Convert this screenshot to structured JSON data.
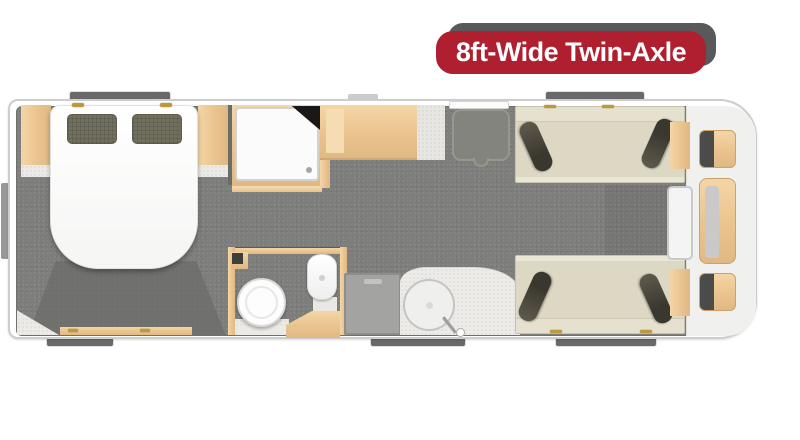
{
  "badge": {
    "label": "8ft-Wide Twin-Axle"
  },
  "colors": {
    "badge_red": "#b01f2f",
    "badge_shadow_gray": "#59595c",
    "badge_text": "#ffffff",
    "carpet_gray": "#7e7e7c",
    "wood_oak": "#e9c28d",
    "sofa_cream": "#ddd8c4",
    "cushion_dark": "#4a463c",
    "bathroom_floor": "#eceae6",
    "wall_white": "#ffffff",
    "window_gray": "#69696b"
  },
  "floorplan": {
    "vehicle": "twin-axle-caravan",
    "width_class": "8ft-wide",
    "layout_from_left": [
      "rear-island-bed-bedroom",
      "corner-shower",
      "washroom-with-toilet-and-basin",
      "wardrobe-kitchen-unit",
      "entrance-door",
      "kitchen-counter-with-sink-and-appliance",
      "lounge-with-twin-sofas",
      "front-chest-and-tables"
    ],
    "furniture": [
      "island-bed",
      "pillows",
      "bedside-cabinet-left",
      "bedside-cabinet-right",
      "shower-tray",
      "wardrobe-unit",
      "worktop",
      "toilet",
      "pedestal-basin",
      "wooden-step",
      "kitchen-appliance",
      "kitchen-counter",
      "round-sink-with-tap",
      "sofa-top",
      "sofa-bottom",
      "bolster-cushions",
      "side-tables",
      "center-table",
      "front-occasional-tables",
      "windows",
      "entrance-door-mat"
    ]
  }
}
